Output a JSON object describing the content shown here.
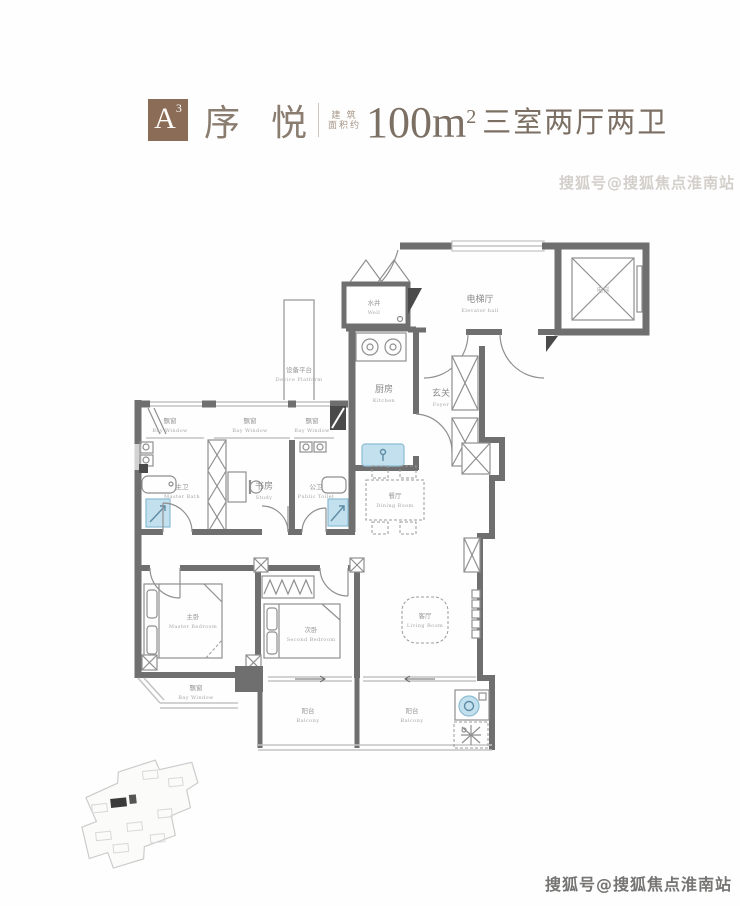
{
  "header": {
    "badge_letter": "A",
    "badge_sup": "3",
    "name": "序 悦",
    "area_note_line1": "建 筑",
    "area_note_line2": "面积约",
    "area_value": "100m",
    "area_sup": "2",
    "layout": "三室两厅两卫",
    "badge_color": "#8a6c57",
    "text_color": "#7c6f63"
  },
  "watermarks": {
    "top": "搜狐号@搜狐焦点淮南站",
    "bottom": "搜狐号@搜狐焦点淮南站"
  },
  "rooms": {
    "well": {
      "zh": "水井",
      "en": "Well"
    },
    "elevator_hall": {
      "zh": "电梯厅",
      "en": "Elevator hall"
    },
    "elevator": {
      "zh": "电梯",
      "en": ""
    },
    "device_platform": {
      "zh": "设备平台",
      "en": "Device Platform"
    },
    "kitchen": {
      "zh": "厨房",
      "en": "Kitchen"
    },
    "foyer": {
      "zh": "玄关",
      "en": "Foyer"
    },
    "bay_window": {
      "zh": "飘窗",
      "en": "Bay Window"
    },
    "master_bath": {
      "zh": "主卫",
      "en": "Master Bath"
    },
    "study": {
      "zh": "书房",
      "en": "Study"
    },
    "public_toilet": {
      "zh": "公卫",
      "en": "Public Toilet"
    },
    "dining_room": {
      "zh": "餐厅",
      "en": "Dining Room"
    },
    "master_bedroom": {
      "zh": "主卧",
      "en": "Master Bedroom"
    },
    "second_bedroom": {
      "zh": "次卧",
      "en": "Second Bedroom"
    },
    "living_room": {
      "zh": "客厅",
      "en": "Living Room"
    },
    "balcony": {
      "zh": "阳台",
      "en": "Balcony"
    }
  }
}
